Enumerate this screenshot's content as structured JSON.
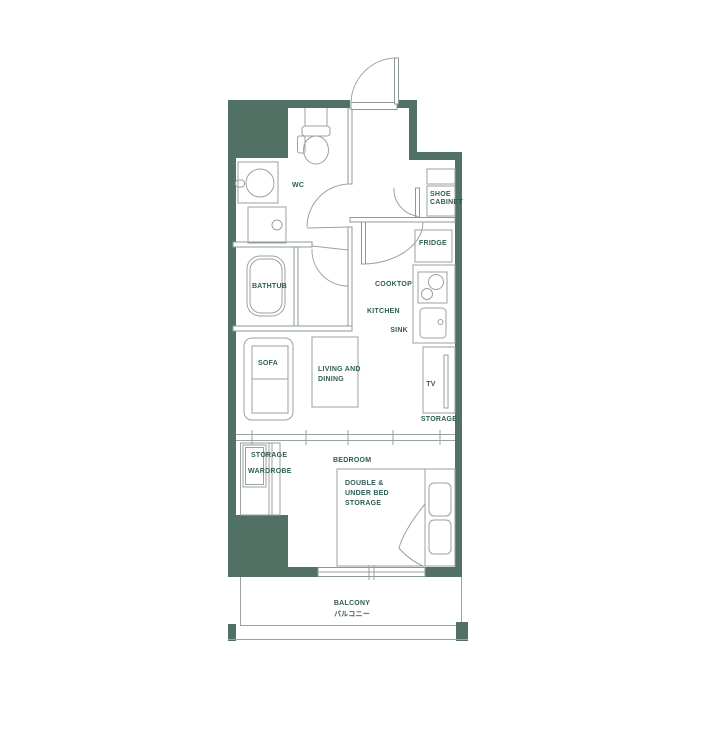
{
  "colors": {
    "wall": "#517164",
    "line": "#9aa39d",
    "line2": "#8d9a93",
    "text": "#2f5e54",
    "bg": "#ffffff"
  },
  "labels": {
    "wc": "WC",
    "shoe_cabinet_line1": "SHOE",
    "shoe_cabinet_line2": "CABINET",
    "fridge": "FRIDGE",
    "cooktop": "COOKTOP",
    "kitchen": "KITCHEN",
    "sink": "SINK",
    "bathtub": "BATHTUB",
    "sofa": "SOFA",
    "living_dining_line1": "LIVING AND",
    "living_dining_line2": "DINING",
    "tv": "TV",
    "tv_storage": "STORAGE",
    "closet_storage": "STORAGE",
    "wardrobe": "WARDROBE",
    "bedroom": "BEDROOM",
    "bed_line1": "DOUBLE &",
    "bed_line2": "UNDER BED",
    "bed_line3": "STORAGE",
    "balcony_en": "BALCONY",
    "balcony_ja": "バルコニー"
  }
}
